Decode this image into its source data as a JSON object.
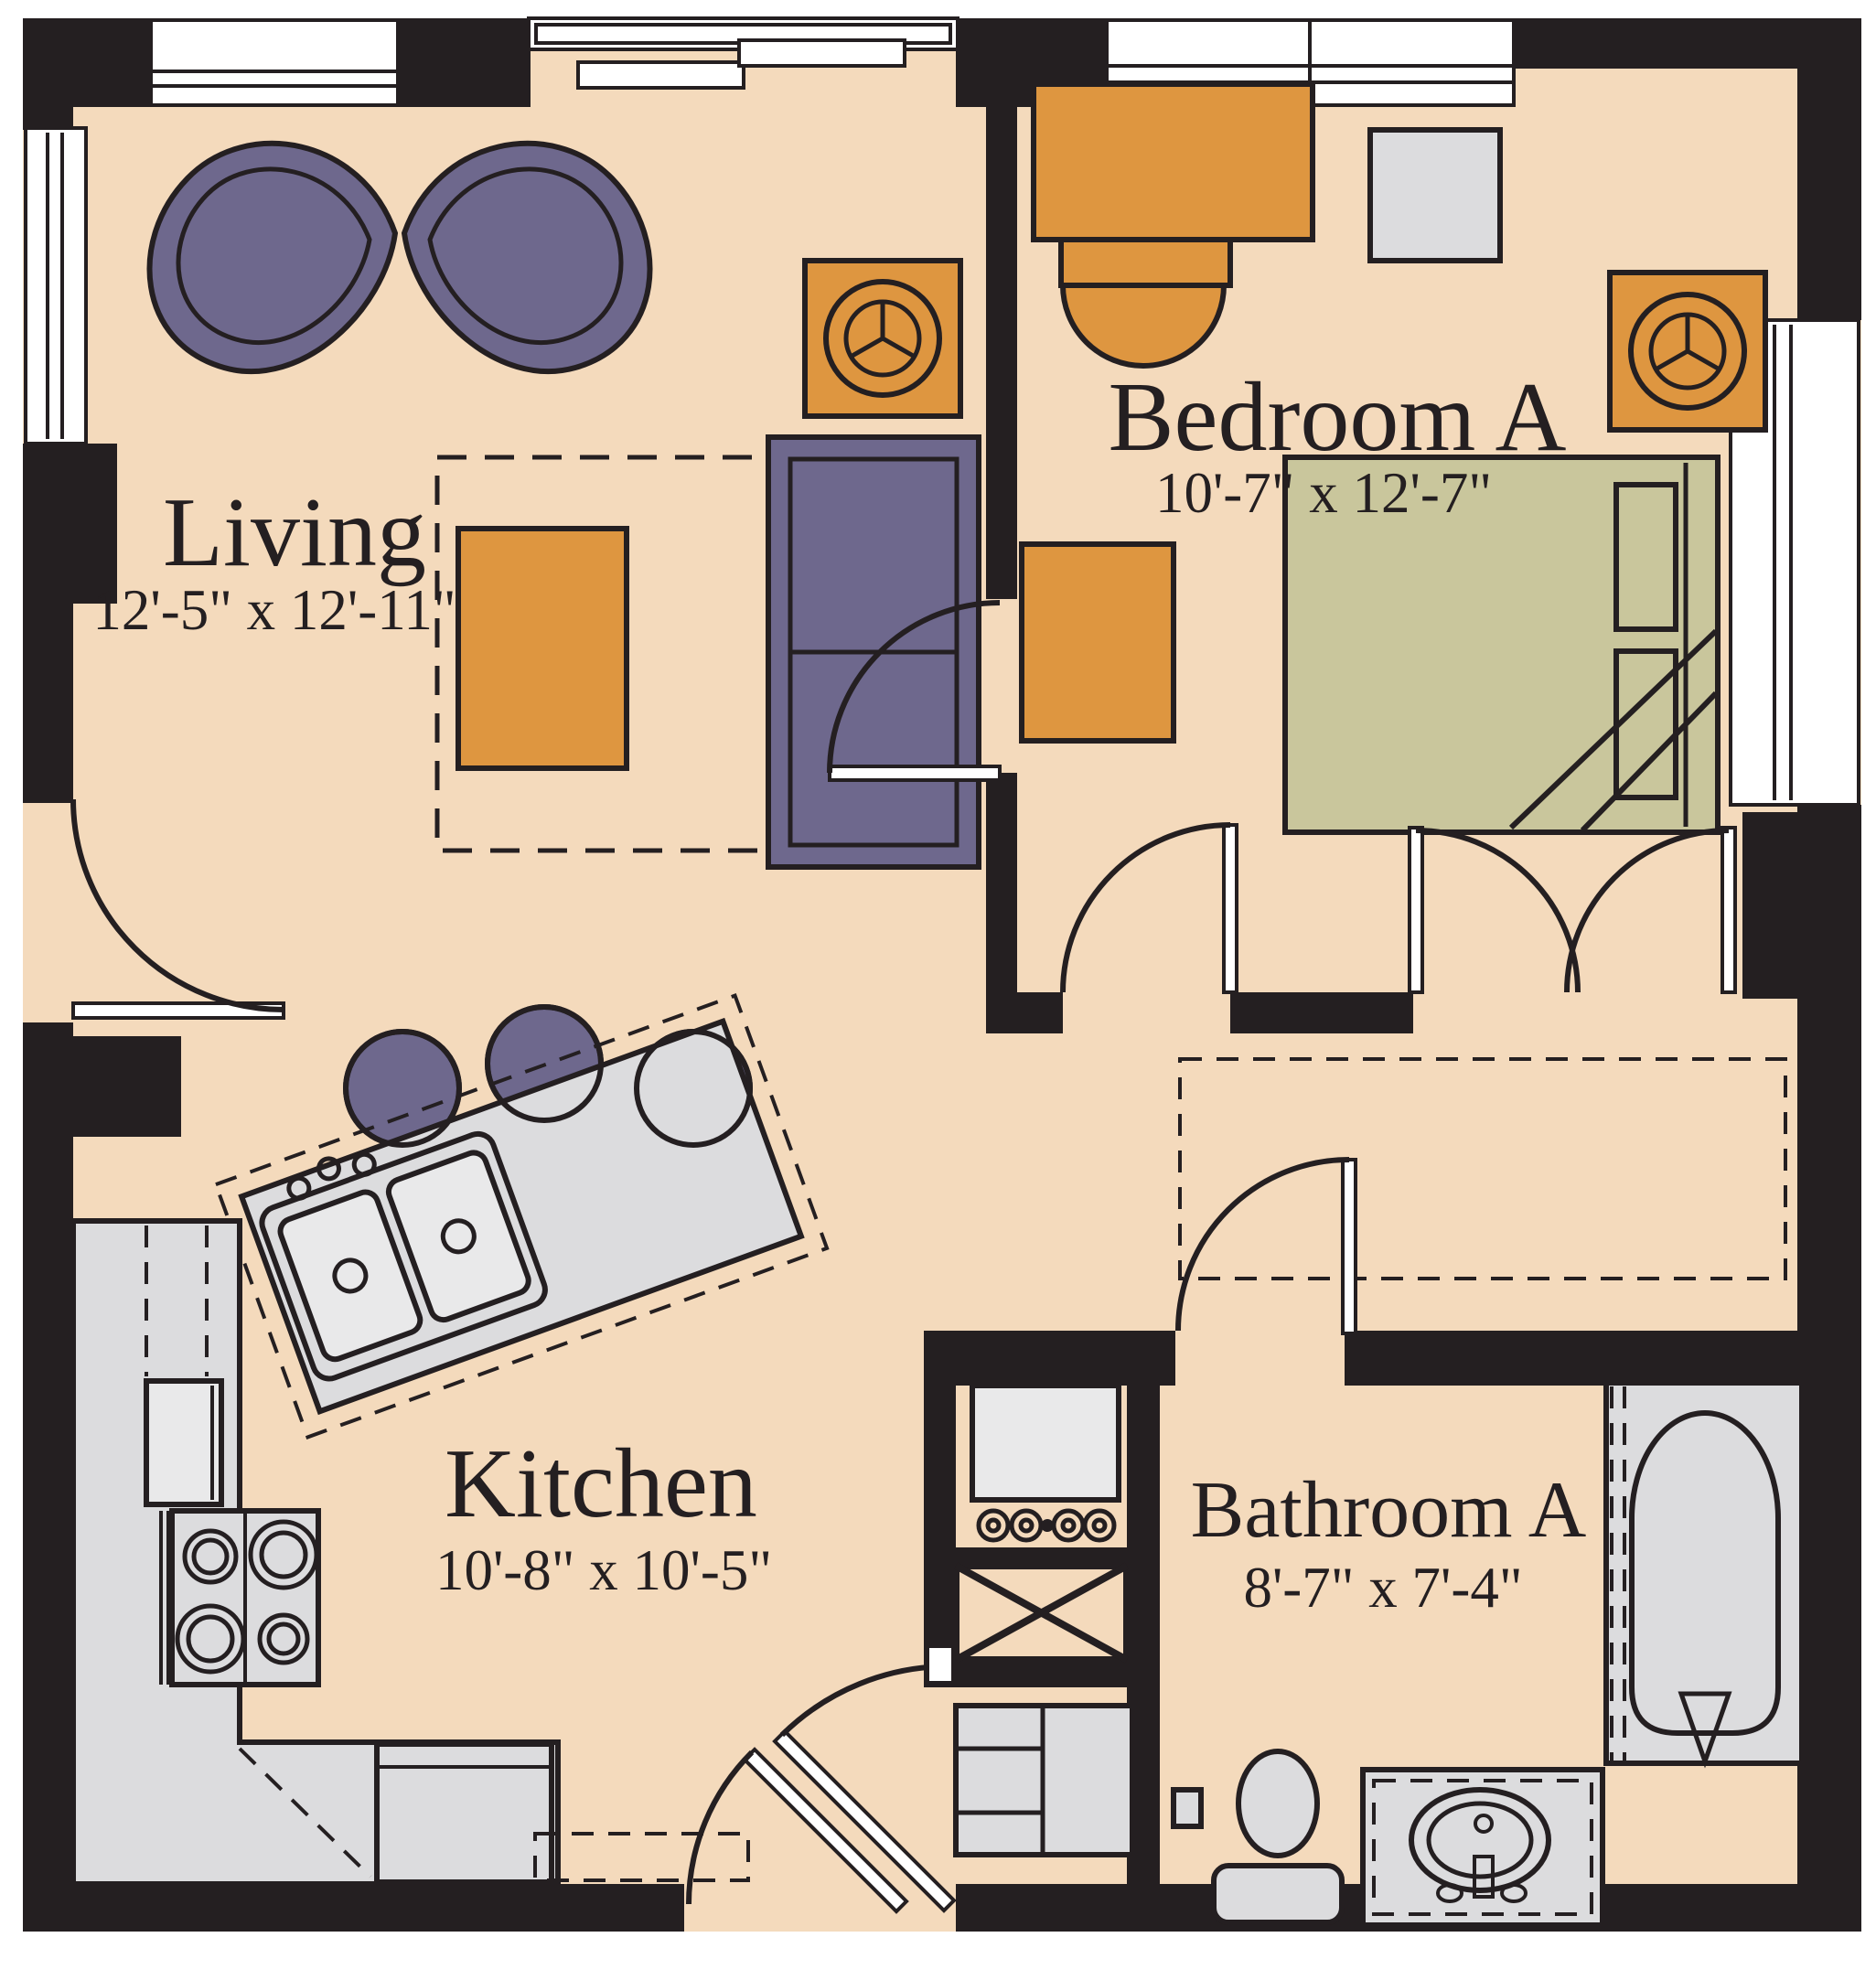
{
  "plan_title": "One-bedroom apartment floor plan",
  "rooms": {
    "living": {
      "name": "Living",
      "dimensions": "12'-5\" x 12'-11\""
    },
    "bedroom_a": {
      "name": "Bedroom A",
      "dimensions": "10'-7\" x 12'-7\""
    },
    "kitchen": {
      "name": "Kitchen",
      "dimensions": "10'-8\" x 10'-5\""
    },
    "bathroom_a": {
      "name": "Bathroom A",
      "dimensions": "8'-7\" x 7'-4\""
    }
  },
  "colors": {
    "floor": "#f4dabc",
    "wall": "#241f21",
    "purple": "#6e688d",
    "orange": "#de9640",
    "olive": "#c9c69c",
    "gray": "#dcdcde",
    "gray_light": "#e9e9ea"
  }
}
